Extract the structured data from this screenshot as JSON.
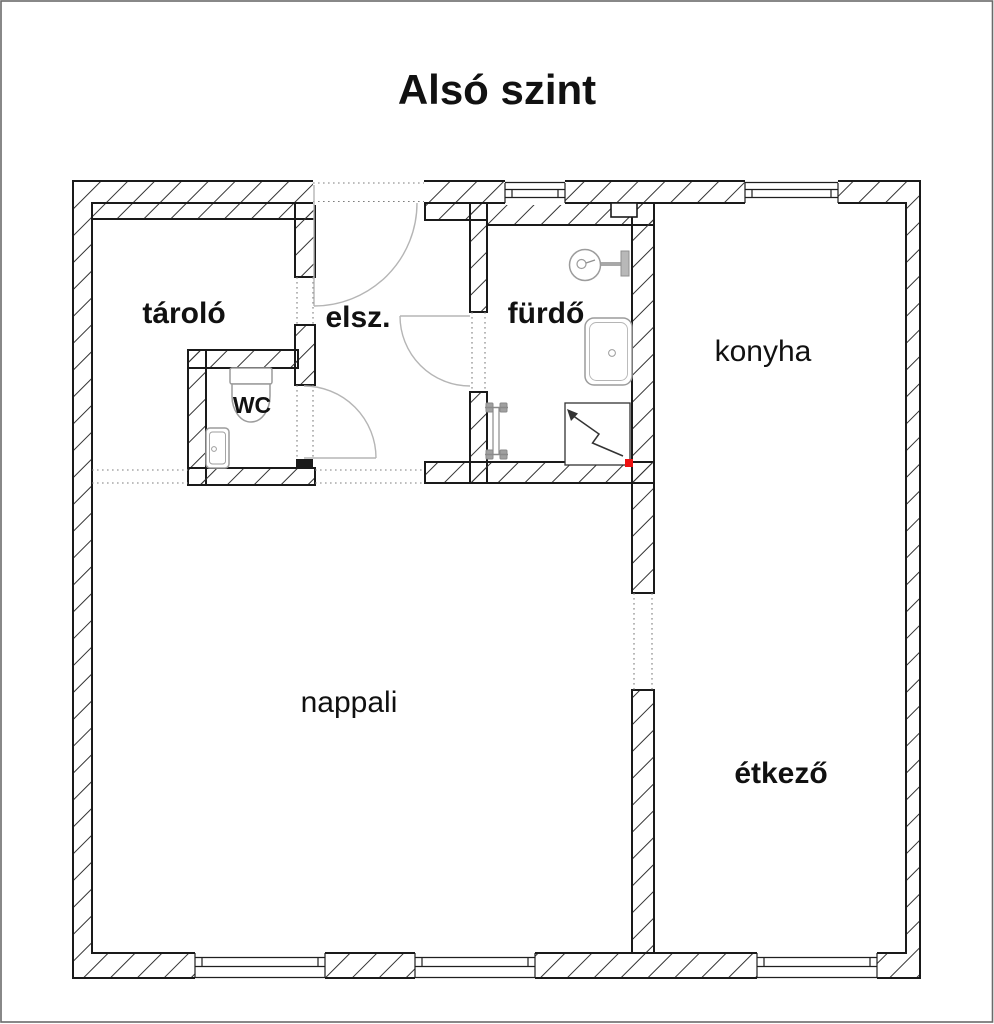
{
  "title": "Alsó szint",
  "floor_plan": {
    "rooms": [
      {
        "id": "tarolo",
        "label": "tároló"
      },
      {
        "id": "elsz",
        "label": "elsz."
      },
      {
        "id": "furdo",
        "label": "fürdő"
      },
      {
        "id": "wc",
        "label": "WC"
      },
      {
        "id": "konyha",
        "label": "konyha"
      },
      {
        "id": "nappali",
        "label": "nappali"
      },
      {
        "id": "etkezo",
        "label": "étkező"
      }
    ],
    "fixtures": [
      "toilet",
      "hand-basin",
      "round-basin",
      "bathtub",
      "shower",
      "radiator",
      "vent-shaft"
    ],
    "colors": {
      "background": "#ffffff",
      "wall_line": "#1a1a1a",
      "hatch_line": "#333333",
      "door_arc": "#b5b5b5",
      "fixture_line": "#9c9c9c",
      "dotted_line": "#7d7d7d",
      "red_marker": "#ee1111",
      "page_border": "#6a6a6a"
    }
  }
}
